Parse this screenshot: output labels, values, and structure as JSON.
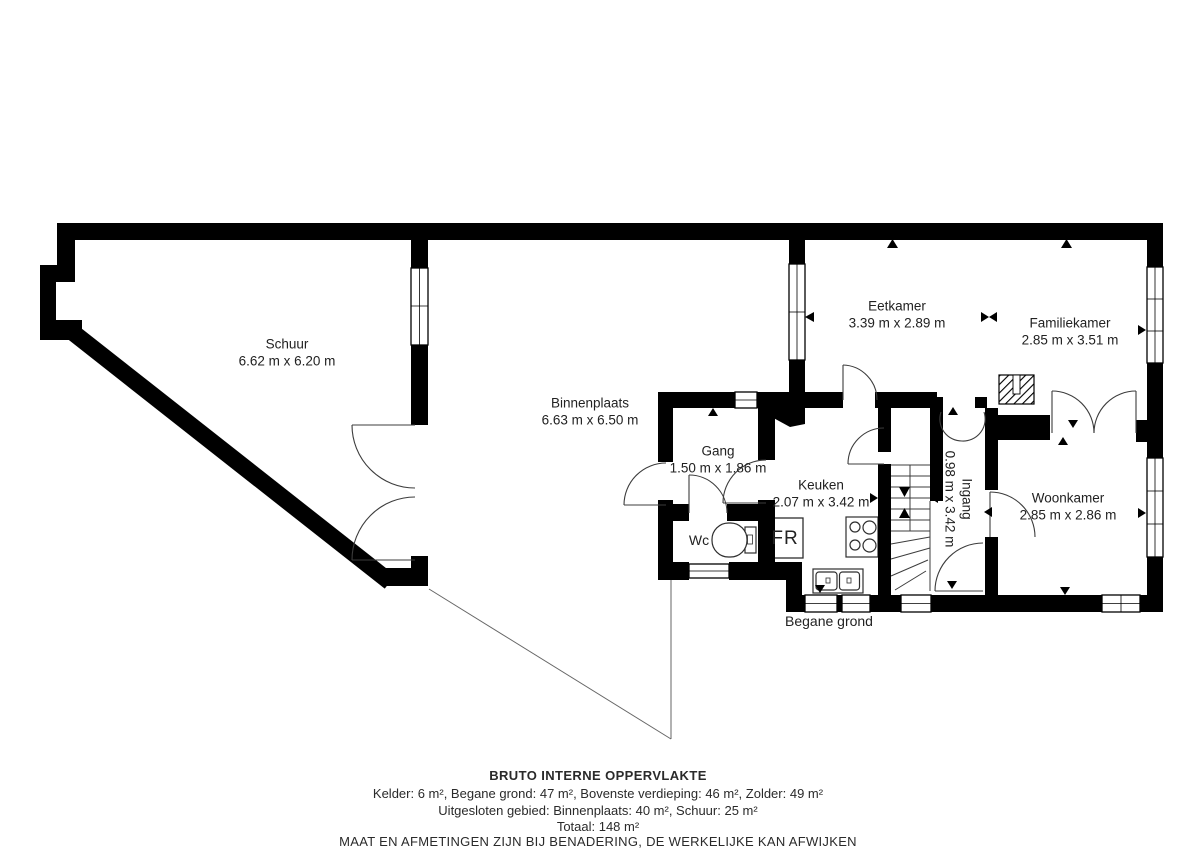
{
  "plan": {
    "floor_label": "Begane grond",
    "rooms": [
      {
        "name": "Schuur",
        "dims": "6.62 m x 6.20 m"
      },
      {
        "name": "Binnenplaats",
        "dims": "6.63 m x 6.50 m"
      },
      {
        "name": "Eetkamer",
        "dims": "3.39 m x 2.89 m"
      },
      {
        "name": "Familiekamer",
        "dims": "2.85 m x 3.51 m"
      },
      {
        "name": "Gang",
        "dims": "1.50 m x 1.86 m"
      },
      {
        "name": "Keuken",
        "dims": "2.07 m x 3.42 m"
      },
      {
        "name": "Ingang",
        "dims": "0.98 m x 3.42 m"
      },
      {
        "name": "Woonkamer",
        "dims": "2.85 m x 2.86 m"
      }
    ],
    "fixtures": {
      "wc_label": "Wc",
      "fridge_label": "FR"
    }
  },
  "footer": {
    "title": "BRUTO INTERNE OPPERVLAKTE",
    "areas_line": "Kelder: 6 m², Begane grond: 47 m², Bovenste verdieping: 46 m², Zolder: 49 m²",
    "excluded_line": "Uitgesloten gebied: Binnenplaats: 40 m², Schuur: 25 m²",
    "total_line": "Totaal: 148 m²",
    "disclaimer": "MAAT EN AFMETINGEN ZIJN BIJ BENADERING, DE WERKELIJKE KAN AFWIJKEN"
  },
  "colors": {
    "wall": "#000000",
    "background": "#ffffff",
    "text": "#222222"
  }
}
